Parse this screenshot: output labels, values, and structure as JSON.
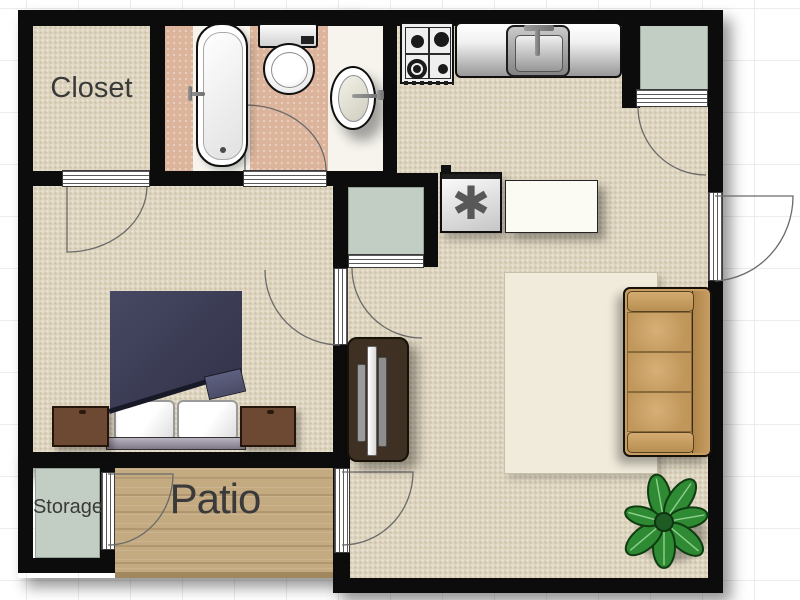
{
  "rooms": {
    "closet": {
      "label": "Closet"
    },
    "storage": {
      "label": "Storage"
    },
    "patio": {
      "label": "Patio"
    }
  },
  "fixtures": {
    "utility_symbol": "✱"
  },
  "colors": {
    "wall": "#0c0c0c",
    "carpet": "#ded5c0",
    "carpet_dot": "#cabfa4",
    "bath_tile": "#dcb49b",
    "sage": "#c2cec3",
    "wood": "#c4aa81",
    "rug_base": "#f1ebdb",
    "sofa": "#c79e63",
    "bed_blanket": "#3c3d55",
    "nightstand": "#6d4832",
    "plant": "#2e8b33"
  },
  "rug_palette": [
    "#a86a32",
    "#c89045",
    "#8a552a",
    "#d9b06a",
    "#5f6349",
    "#97773f",
    "#7d89a0",
    "#e8d8b0",
    "#b3402a",
    "#6a4a22",
    "#d8c9a2",
    "#4f5a6e",
    "#c4701f",
    "#efe6cc"
  ]
}
